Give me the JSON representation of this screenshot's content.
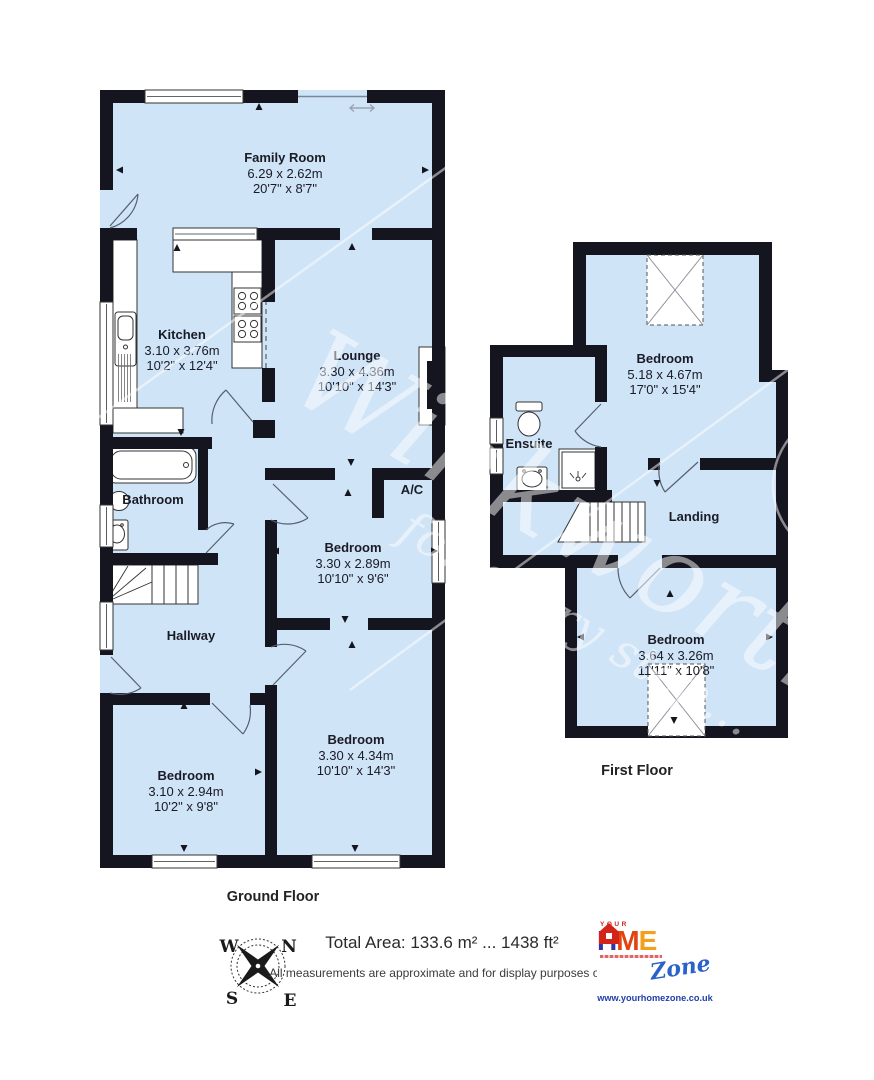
{
  "watermark": {
    "brand": "Winkworth",
    "tagline": "for every step..."
  },
  "ground_floor": {
    "title": "Ground Floor",
    "rooms": [
      {
        "name": "Family Room",
        "metric": "6.29 x 2.62m",
        "imperial": "20'7\" x 8'7\""
      },
      {
        "name": "Kitchen",
        "metric": "3.10 x 3.76m",
        "imperial": "10'2\" x 12'4\""
      },
      {
        "name": "Lounge",
        "metric": "3.30 x 4.36m",
        "imperial": "10'10\" x 14'3\""
      },
      {
        "name": "Bathroom",
        "metric": "",
        "imperial": ""
      },
      {
        "name": "A/C",
        "metric": "",
        "imperial": ""
      },
      {
        "name": "Bedroom",
        "metric": "3.30 x 2.89m",
        "imperial": "10'10\" x 9'6\""
      },
      {
        "name": "Hallway",
        "metric": "",
        "imperial": ""
      },
      {
        "name": "Bedroom",
        "metric": "3.10 x 2.94m",
        "imperial": "10'2\" x 9'8\""
      },
      {
        "name": "Bedroom",
        "metric": "3.30 x 4.34m",
        "imperial": "10'10\" x 14'3\""
      }
    ]
  },
  "first_floor": {
    "title": "First Floor",
    "rooms": [
      {
        "name": "Bedroom",
        "metric": "5.18 x 4.67m",
        "imperial": "17'0\" x 15'4\""
      },
      {
        "name": "Ensuite",
        "metric": "",
        "imperial": ""
      },
      {
        "name": "Landing",
        "metric": "",
        "imperial": ""
      },
      {
        "name": "Bedroom",
        "metric": "3.64 x 3.26m",
        "imperial": "11'11\" x 10'8\""
      }
    ]
  },
  "footer": {
    "total_area": "Total Area: 133.6 m² ... 1438 ft²",
    "disclaimer": "All measurements are approximate and for display purposes only",
    "compass": {
      "west": "W",
      "north": "N",
      "south": "S",
      "east": "E"
    },
    "logo": {
      "your": "YOUR",
      "h": "H",
      "m": "M",
      "e": "E",
      "zone": "Zone",
      "url": "www.yourhomezone.co.uk"
    }
  },
  "colors": {
    "room_fill": "#cfe4f7",
    "wall": "#15151f",
    "watermark": "#ffffff",
    "logo_h": "#3534a6",
    "logo_house": "#d42318",
    "logo_m": "#e2440f",
    "logo_e": "#f4a01c",
    "logo_zone": "#2a62c9",
    "logo_url": "#1f3faa"
  }
}
